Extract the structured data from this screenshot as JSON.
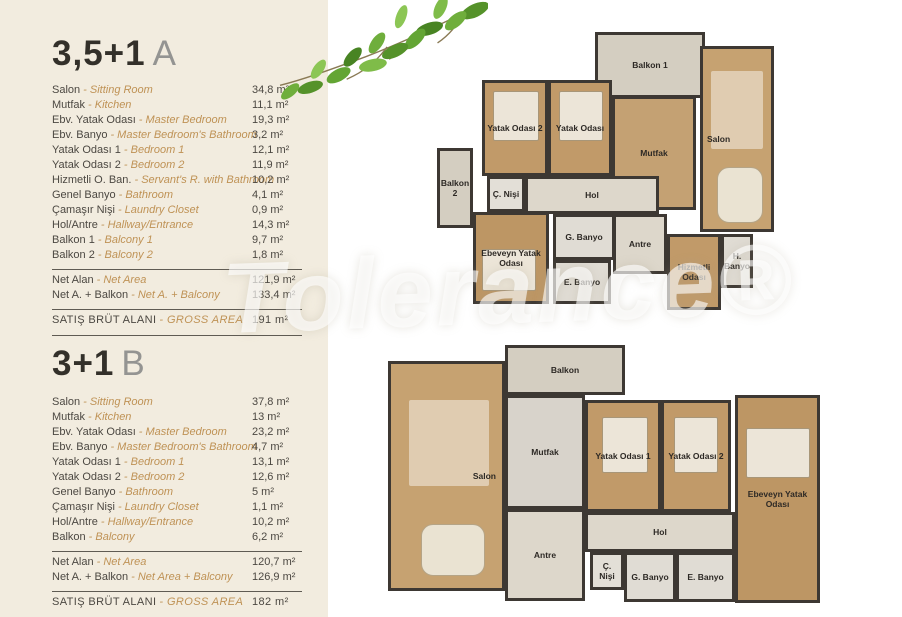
{
  "watermark": "Tolerance®",
  "colors": {
    "panel_bg": "#f2ecdf",
    "accent_gold": "#bf9255",
    "wall": "#3d3833",
    "wood_floor": "#c6a271",
    "tile_floor": "#ddd7cb",
    "text_dark": "#4c4842"
  },
  "plan_a": {
    "title_code": "3,5+1",
    "title_variant": "A",
    "items": [
      {
        "tr": "Salon",
        "en": "- Sitting Room",
        "value": "34,8 m²"
      },
      {
        "tr": "Mutfak",
        "en": "- Kitchen",
        "value": "11,1 m²"
      },
      {
        "tr": "Ebv. Yatak Odası",
        "en": "- Master Bedroom",
        "value": "19,3 m²"
      },
      {
        "tr": "Ebv. Banyo",
        "en": "- Master Bedroom's Bathroom",
        "value": "3,2 m²"
      },
      {
        "tr": "Yatak Odası 1",
        "en": "- Bedroom 1",
        "value": "12,1 m²"
      },
      {
        "tr": "Yatak Odası 2",
        "en": "- Bedroom 2",
        "value": "11,9 m²"
      },
      {
        "tr": "Hizmetli O. Ban.",
        "en": "- Servant's R. with Bathroom",
        "value": "10,2 m²"
      },
      {
        "tr": "Genel Banyo",
        "en": "- Bathroom",
        "value": "4,1 m²"
      },
      {
        "tr": "Çamaşır Nişi",
        "en": "- Laundry Closet",
        "value": "0,9 m²"
      },
      {
        "tr": "Hol/Antre",
        "en": "- Hallway/Entrance",
        "value": "14,3 m²"
      },
      {
        "tr": "Balkon 1",
        "en": "- Balcony 1",
        "value": "9,7 m²"
      },
      {
        "tr": "Balkon 2",
        "en": "- Balcony 2",
        "value": "1,8 m²"
      }
    ],
    "totals": [
      {
        "tr": "Net Alan",
        "en": "- Net Area",
        "value": "121,9 m²"
      },
      {
        "tr": "Net A. + Balkon",
        "en": "- Net A. + Balcony",
        "value": "133,4 m²"
      }
    ],
    "gross": {
      "tr": "SATIŞ BRÜT ALANI",
      "en": "- GROSS AREA",
      "value": "191 m²"
    },
    "rooms": [
      "Balkon 1",
      "Yatak Odası 2",
      "Yatak Odası",
      "Mutfak",
      "Salon",
      "Balkon 2",
      "Ç. Nişi",
      "Hol",
      "G. Banyo",
      "Ebeveyn Yatak Odası",
      "Antre",
      "E. Banyo",
      "Hizmetli Odası",
      "H. Banyo"
    ]
  },
  "plan_b": {
    "title_code": "3+1",
    "title_variant": "B",
    "items": [
      {
        "tr": "Salon",
        "en": "- Sitting Room",
        "value": "37,8 m²"
      },
      {
        "tr": "Mutfak",
        "en": "- Kitchen",
        "value": "13 m²"
      },
      {
        "tr": "Ebv. Yatak Odası",
        "en": "- Master Bedroom",
        "value": "23,2 m²"
      },
      {
        "tr": "Ebv. Banyo",
        "en": "- Master Bedroom's Bathroom",
        "value": "4,7 m²"
      },
      {
        "tr": "Yatak Odası 1",
        "en": "- Bedroom 1",
        "value": "13,1 m²"
      },
      {
        "tr": "Yatak Odası 2",
        "en": "- Bedroom 2",
        "value": "12,6 m²"
      },
      {
        "tr": "Genel Banyo",
        "en": "- Bathroom",
        "value": "5 m²"
      },
      {
        "tr": "Çamaşır Nişi",
        "en": "- Laundry Closet",
        "value": "1,1 m²"
      },
      {
        "tr": "Hol/Antre",
        "en": "- Hallway/Entrance",
        "value": "10,2 m²"
      },
      {
        "tr": "Balkon",
        "en": "- Balcony",
        "value": "6,2 m²"
      }
    ],
    "totals": [
      {
        "tr": "Net Alan",
        "en": "- Net Area",
        "value": "120,7 m²"
      },
      {
        "tr": "Net A. + Balkon",
        "en": "- Net Area + Balcony",
        "value": "126,9 m²"
      }
    ],
    "gross": {
      "tr": "SATIŞ BRÜT ALANI",
      "en": "- GROSS AREA",
      "value": "182 m²"
    },
    "rooms": [
      "Balkon",
      "Salon",
      "Mutfak",
      "Yatak Odası 1",
      "Yatak Odası 2",
      "Ebeveyn Yatak Odası",
      "Hol",
      "Antre",
      "Ç. Nişi",
      "G. Banyo",
      "E. Banyo"
    ]
  }
}
